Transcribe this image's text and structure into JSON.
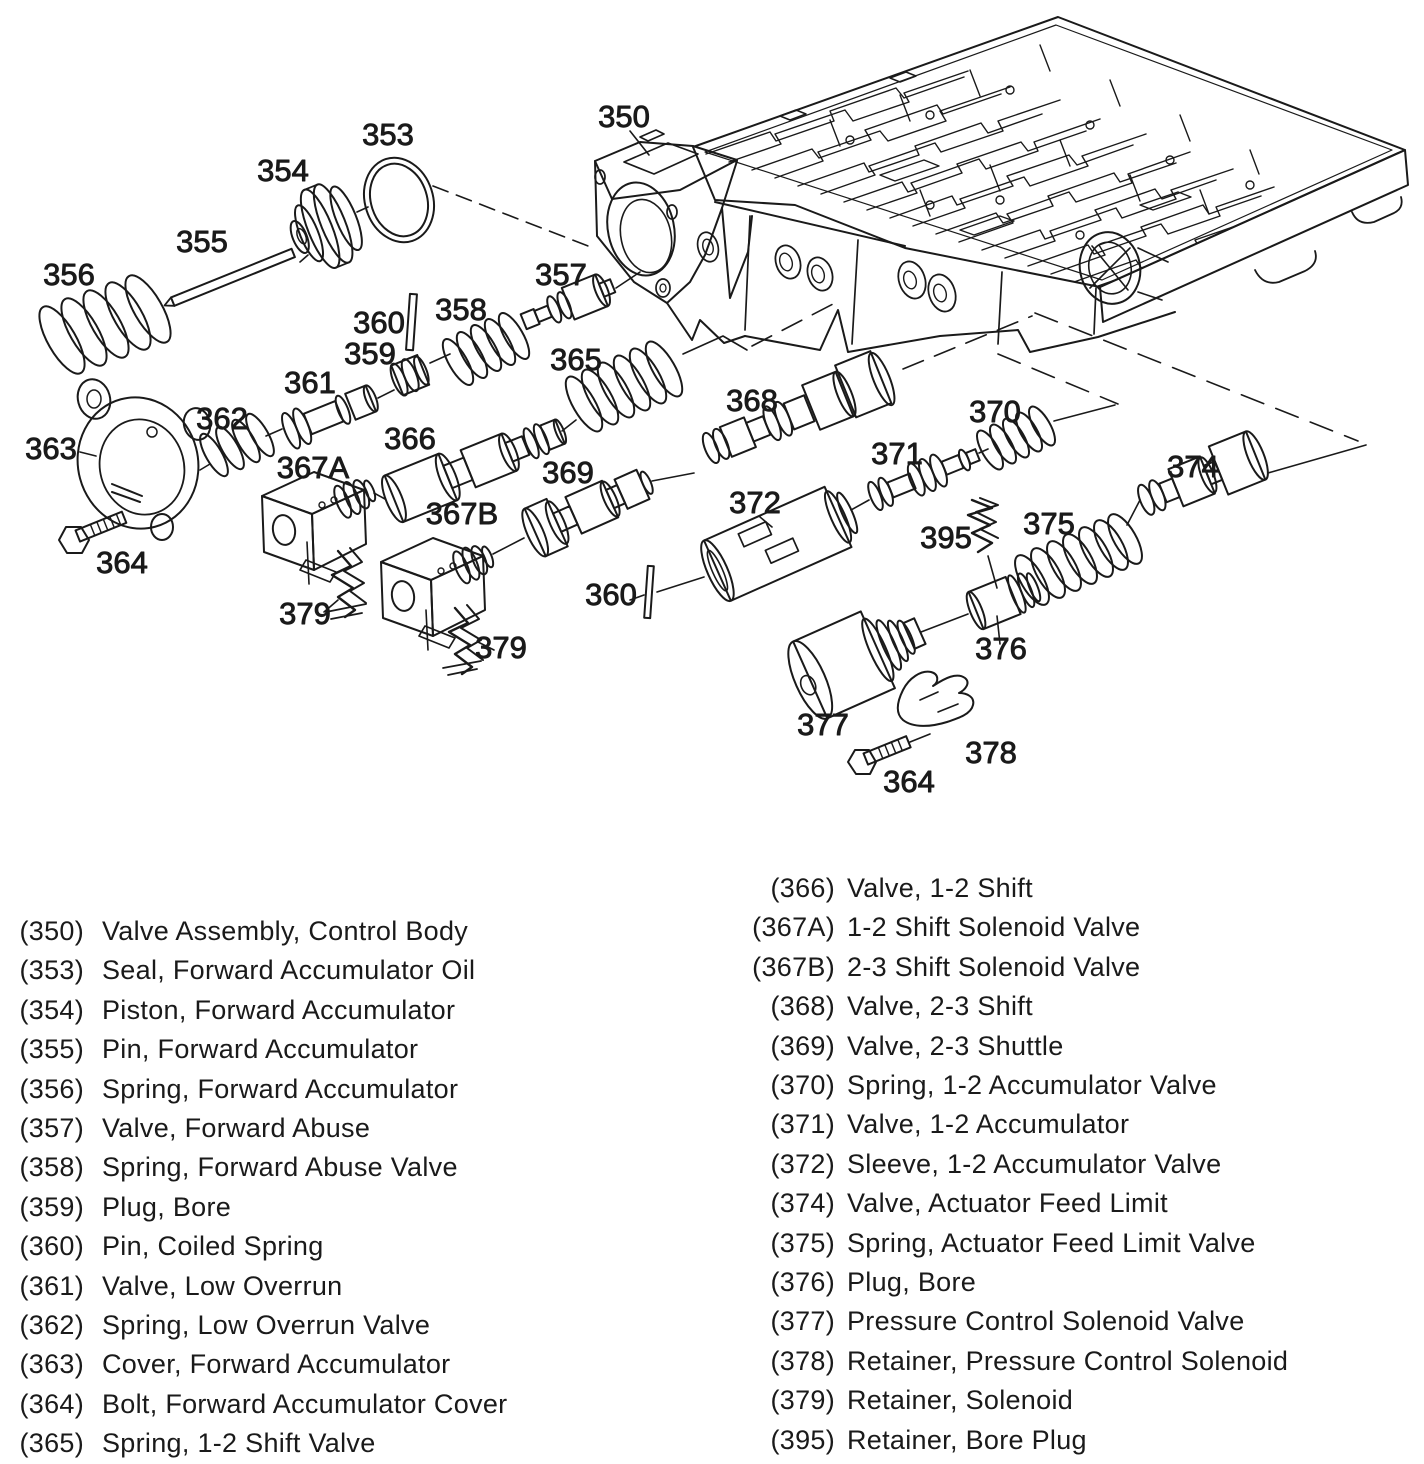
{
  "colors": {
    "ink": "#1a1a1a",
    "paper": "#ffffff"
  },
  "figure": {
    "description": "Exploded view, transmission control valve body assembly",
    "callouts": [
      {
        "label": "350",
        "x": 624,
        "y": 127
      },
      {
        "label": "353",
        "x": 388,
        "y": 145
      },
      {
        "label": "354",
        "x": 283,
        "y": 181
      },
      {
        "label": "355",
        "x": 202,
        "y": 252
      },
      {
        "label": "356",
        "x": 69,
        "y": 285
      },
      {
        "label": "357",
        "x": 561,
        "y": 285
      },
      {
        "label": "358",
        "x": 461,
        "y": 320
      },
      {
        "label": "360",
        "x": 379,
        "y": 333
      },
      {
        "label": "359",
        "x": 370,
        "y": 364
      },
      {
        "label": "361",
        "x": 310,
        "y": 393
      },
      {
        "label": "365",
        "x": 576,
        "y": 370
      },
      {
        "label": "362",
        "x": 222,
        "y": 429
      },
      {
        "label": "366",
        "x": 410,
        "y": 449
      },
      {
        "label": "368",
        "x": 752,
        "y": 411
      },
      {
        "label": "370",
        "x": 995,
        "y": 422
      },
      {
        "label": "363",
        "x": 51,
        "y": 459
      },
      {
        "label": "367A",
        "x": 313,
        "y": 478
      },
      {
        "label": "371",
        "x": 897,
        "y": 464
      },
      {
        "label": "369",
        "x": 568,
        "y": 483
      },
      {
        "label": "372",
        "x": 755,
        "y": 513
      },
      {
        "label": "374",
        "x": 1193,
        "y": 477
      },
      {
        "label": "367B",
        "x": 462,
        "y": 524
      },
      {
        "label": "375",
        "x": 1049,
        "y": 534
      },
      {
        "label": "395",
        "x": 946,
        "y": 548
      },
      {
        "label": "364",
        "x": 122,
        "y": 573
      },
      {
        "label": "360",
        "x": 611,
        "y": 605
      },
      {
        "label": "379",
        "x": 305,
        "y": 624
      },
      {
        "label": "379",
        "x": 501,
        "y": 658
      },
      {
        "label": "376",
        "x": 1001,
        "y": 659
      },
      {
        "label": "377",
        "x": 823,
        "y": 735
      },
      {
        "label": "378",
        "x": 991,
        "y": 763
      },
      {
        "label": "364",
        "x": 909,
        "y": 792
      }
    ]
  },
  "parts_list": {
    "left": [
      {
        "num": "(350)",
        "name": "Valve Assembly, Control Body"
      },
      {
        "num": "(353)",
        "name": "Seal, Forward Accumulator Oil"
      },
      {
        "num": "(354)",
        "name": "Piston, Forward Accumulator"
      },
      {
        "num": "(355)",
        "name": "Pin, Forward Accumulator"
      },
      {
        "num": "(356)",
        "name": "Spring, Forward Accumulator"
      },
      {
        "num": "(357)",
        "name": "Valve, Forward Abuse"
      },
      {
        "num": "(358)",
        "name": "Spring, Forward Abuse Valve"
      },
      {
        "num": "(359)",
        "name": "Plug, Bore"
      },
      {
        "num": "(360)",
        "name": "Pin, Coiled Spring"
      },
      {
        "num": "(361)",
        "name": "Valve, Low Overrun"
      },
      {
        "num": "(362)",
        "name": "Spring, Low Overrun Valve"
      },
      {
        "num": "(363)",
        "name": "Cover, Forward Accumulator"
      },
      {
        "num": "(364)",
        "name": "Bolt, Forward Accumulator Cover"
      },
      {
        "num": "(365)",
        "name": "Spring, 1-2 Shift Valve"
      }
    ],
    "right": [
      {
        "num": "(366)",
        "name": "Valve, 1-2 Shift"
      },
      {
        "num": "(367A)",
        "name": "1-2 Shift Solenoid Valve"
      },
      {
        "num": "(367B)",
        "name": "2-3 Shift Solenoid Valve"
      },
      {
        "num": "(368)",
        "name": "Valve, 2-3 Shift"
      },
      {
        "num": "(369)",
        "name": "Valve, 2-3 Shuttle"
      },
      {
        "num": "(370)",
        "name": "Spring, 1-2 Accumulator Valve"
      },
      {
        "num": "(371)",
        "name": "Valve, 1-2 Accumulator"
      },
      {
        "num": "(372)",
        "name": "Sleeve, 1-2 Accumulator Valve"
      },
      {
        "num": "(374)",
        "name": "Valve, Actuator Feed Limit"
      },
      {
        "num": "(375)",
        "name": "Spring, Actuator Feed Limit Valve"
      },
      {
        "num": "(376)",
        "name": "Plug, Bore"
      },
      {
        "num": "(377)",
        "name": "Pressure Control Solenoid Valve"
      },
      {
        "num": "(378)",
        "name": "Retainer, Pressure Control Solenoid"
      },
      {
        "num": "(379)",
        "name": "Retainer, Solenoid"
      },
      {
        "num": "(395)",
        "name": "Retainer, Bore Plug"
      }
    ]
  }
}
